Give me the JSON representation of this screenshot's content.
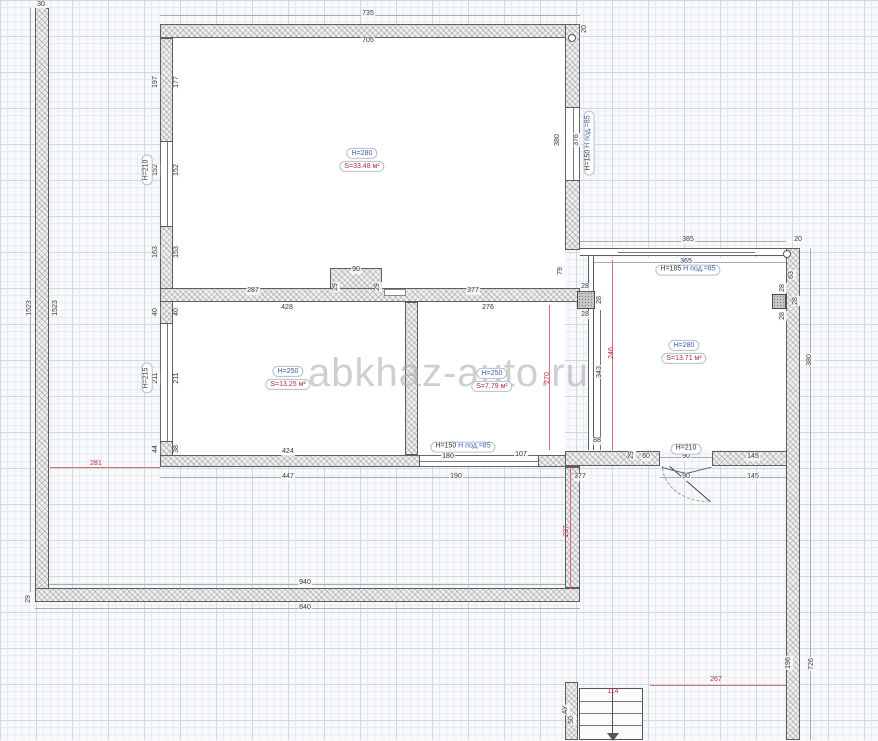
{
  "watermark": "abkhaz-auto.ru",
  "colors": {
    "dimension_text": "#3a3a3a",
    "red_dimension": "#c03040",
    "blue_label": "#3a5fa8",
    "wall_border": "#5d5d5d",
    "grid": "#dfe3e8",
    "watermark": "#a5a8ac"
  },
  "rooms": [
    {
      "id": "room-top",
      "height_label": "H=280",
      "area_label": "S=33.48 м²",
      "x": 362,
      "y": 160
    },
    {
      "id": "room-lower-left",
      "height_label": "H=250",
      "area_label": "S=13.25 м²",
      "x": 288,
      "y": 378
    },
    {
      "id": "room-lower-middle",
      "height_label": "H=250",
      "area_label": "S=7.79 м²",
      "x": 492,
      "y": 380
    },
    {
      "id": "room-right",
      "height_label": "H=280",
      "area_label": "S=13.71 м²",
      "x": 684,
      "y": 352
    }
  ],
  "opening_labels": [
    {
      "black": "H=185",
      "blue": "H под.=85",
      "x": 688,
      "y": 270,
      "rot": 0
    },
    {
      "black": "H=150",
      "blue": "H под.=85",
      "x": 463,
      "y": 447,
      "rot": 0
    },
    {
      "black": "H=150",
      "blue": "H под.=85",
      "x": 589,
      "y": 143,
      "rot": 90
    },
    {
      "black": "H=210",
      "blue": "",
      "x": 686,
      "y": 449,
      "rot": 0
    },
    {
      "black": "H=210",
      "blue": "",
      "x": 147,
      "y": 170,
      "rot": 90
    },
    {
      "black": "H=215",
      "blue": "",
      "x": 147,
      "y": 378,
      "rot": 90
    }
  ],
  "dims": [
    {
      "label": "30",
      "x": 41,
      "y": 5,
      "rot": 0,
      "color": "dark"
    },
    {
      "label": "735",
      "x": 368,
      "y": 14,
      "rot": 0,
      "color": "dark"
    },
    {
      "label": "705",
      "x": 368,
      "y": 41,
      "rot": 0,
      "color": "dark"
    },
    {
      "label": "20",
      "x": 585,
      "y": 29,
      "rot": 90,
      "color": "dark"
    },
    {
      "label": "197",
      "x": 156,
      "y": 82,
      "rot": 90,
      "color": "dark"
    },
    {
      "label": "177",
      "x": 177,
      "y": 82,
      "rot": 90,
      "color": "dark"
    },
    {
      "label": "152",
      "x": 156,
      "y": 170,
      "rot": 90,
      "color": "dark"
    },
    {
      "label": "152",
      "x": 177,
      "y": 170,
      "rot": 90,
      "color": "dark"
    },
    {
      "label": "163",
      "x": 156,
      "y": 252,
      "rot": 90,
      "color": "dark"
    },
    {
      "label": "153",
      "x": 177,
      "y": 252,
      "rot": 90,
      "color": "dark"
    },
    {
      "label": "380",
      "x": 558,
      "y": 140,
      "rot": 90,
      "color": "dark"
    },
    {
      "label": "376",
      "x": 577,
      "y": 140,
      "rot": 90,
      "color": "dark"
    },
    {
      "label": "1523",
      "x": 30,
      "y": 308,
      "rot": 90,
      "color": "dark"
    },
    {
      "label": "1523",
      "x": 56,
      "y": 308,
      "rot": 90,
      "color": "dark"
    },
    {
      "label": "287",
      "x": 253,
      "y": 291,
      "rot": 0,
      "color": "dark"
    },
    {
      "label": "90",
      "x": 356,
      "y": 270,
      "rot": 0,
      "color": "dark"
    },
    {
      "label": "29",
      "x": 336,
      "y": 287,
      "rot": 90,
      "color": "dark"
    },
    {
      "label": "29",
      "x": 378,
      "y": 287,
      "rot": 90,
      "color": "dark"
    },
    {
      "label": "377",
      "x": 473,
      "y": 291,
      "rot": 0,
      "color": "dark"
    },
    {
      "label": "79",
      "x": 561,
      "y": 271,
      "rot": 90,
      "color": "dark"
    },
    {
      "label": "40",
      "x": 156,
      "y": 312,
      "rot": 90,
      "color": "dark"
    },
    {
      "label": "40",
      "x": 177,
      "y": 312,
      "rot": 90,
      "color": "dark"
    },
    {
      "label": "211",
      "x": 156,
      "y": 378,
      "rot": 90,
      "color": "dark"
    },
    {
      "label": "211",
      "x": 177,
      "y": 378,
      "rot": 90,
      "color": "dark"
    },
    {
      "label": "44",
      "x": 156,
      "y": 449,
      "rot": 90,
      "color": "dark"
    },
    {
      "label": "38",
      "x": 177,
      "y": 449,
      "rot": 90,
      "color": "dark"
    },
    {
      "label": "428",
      "x": 287,
      "y": 308,
      "rot": 0,
      "color": "dark"
    },
    {
      "label": "276",
      "x": 488,
      "y": 308,
      "rot": 0,
      "color": "dark"
    },
    {
      "label": "270",
      "x": 548,
      "y": 378,
      "rot": 90,
      "color": "red"
    },
    {
      "label": "424",
      "x": 288,
      "y": 452,
      "rot": 0,
      "color": "dark"
    },
    {
      "label": "447",
      "x": 288,
      "y": 477,
      "rot": 0,
      "color": "dark"
    },
    {
      "label": "180",
      "x": 448,
      "y": 457,
      "rot": 0,
      "color": "dark"
    },
    {
      "label": "107",
      "x": 521,
      "y": 455,
      "rot": 0,
      "color": "dark"
    },
    {
      "label": "190",
      "x": 456,
      "y": 477,
      "rot": 0,
      "color": "dark"
    },
    {
      "label": "377",
      "x": 580,
      "y": 477,
      "rot": 0,
      "color": "dark"
    },
    {
      "label": "385",
      "x": 688,
      "y": 240,
      "rot": 0,
      "color": "dark"
    },
    {
      "label": "20",
      "x": 798,
      "y": 240,
      "rot": 0,
      "color": "dark"
    },
    {
      "label": "365",
      "x": 686,
      "y": 262,
      "rot": 0,
      "color": "dark"
    },
    {
      "label": "63",
      "x": 792,
      "y": 275,
      "rot": 90,
      "color": "dark"
    },
    {
      "label": "28",
      "x": 783,
      "y": 288,
      "rot": 90,
      "color": "dark"
    },
    {
      "label": "28",
      "x": 796,
      "y": 301,
      "rot": 90,
      "color": "dark"
    },
    {
      "label": "28",
      "x": 783,
      "y": 316,
      "rot": 90,
      "color": "dark"
    },
    {
      "label": "28",
      "x": 585,
      "y": 287,
      "rot": 0,
      "color": "dark"
    },
    {
      "label": "28",
      "x": 600,
      "y": 300,
      "rot": 90,
      "color": "dark"
    },
    {
      "label": "28",
      "x": 585,
      "y": 315,
      "rot": 0,
      "color": "dark"
    },
    {
      "label": "343",
      "x": 600,
      "y": 372,
      "rot": 90,
      "color": "dark"
    },
    {
      "label": "246",
      "x": 612,
      "y": 353,
      "rot": 90,
      "color": "red"
    },
    {
      "label": "88",
      "x": 597,
      "y": 441,
      "rot": 0,
      "color": "dark"
    },
    {
      "label": "29",
      "x": 632,
      "y": 455,
      "rot": 90,
      "color": "dark"
    },
    {
      "label": "60",
      "x": 646,
      "y": 457,
      "rot": 0,
      "color": "dark"
    },
    {
      "label": "90",
      "x": 686,
      "y": 457,
      "rot": 0,
      "color": "dark"
    },
    {
      "label": "145",
      "x": 753,
      "y": 457,
      "rot": 0,
      "color": "dark"
    },
    {
      "label": "90",
      "x": 686,
      "y": 477,
      "rot": 0,
      "color": "dark"
    },
    {
      "label": "145",
      "x": 753,
      "y": 477,
      "rot": 0,
      "color": "dark"
    },
    {
      "label": "940",
      "x": 305,
      "y": 583,
      "rot": 0,
      "color": "dark"
    },
    {
      "label": "840",
      "x": 305,
      "y": 608,
      "rot": 0,
      "color": "dark"
    },
    {
      "label": "29",
      "x": 29,
      "y": 599,
      "rot": 90,
      "color": "dark"
    },
    {
      "label": "281",
      "x": 96,
      "y": 464,
      "rot": 0,
      "color": "red"
    },
    {
      "label": "237",
      "x": 567,
      "y": 531,
      "rot": 90,
      "color": "red"
    },
    {
      "label": "267",
      "x": 716,
      "y": 680,
      "rot": 0,
      "color": "red"
    },
    {
      "label": "114",
      "x": 613,
      "y": 692,
      "rot": 0,
      "color": "red"
    },
    {
      "label": "50",
      "x": 572,
      "y": 720,
      "rot": 90,
      "color": "dark"
    },
    {
      "label": "АУ",
      "x": 566,
      "y": 710,
      "rot": 90,
      "color": "dark"
    },
    {
      "label": "196",
      "x": 789,
      "y": 663,
      "rot": 90,
      "color": "dark"
    },
    {
      "label": "726",
      "x": 812,
      "y": 664,
      "rot": 90,
      "color": "dark"
    },
    {
      "label": "380",
      "x": 810,
      "y": 360,
      "rot": 90,
      "color": "dark"
    }
  ]
}
